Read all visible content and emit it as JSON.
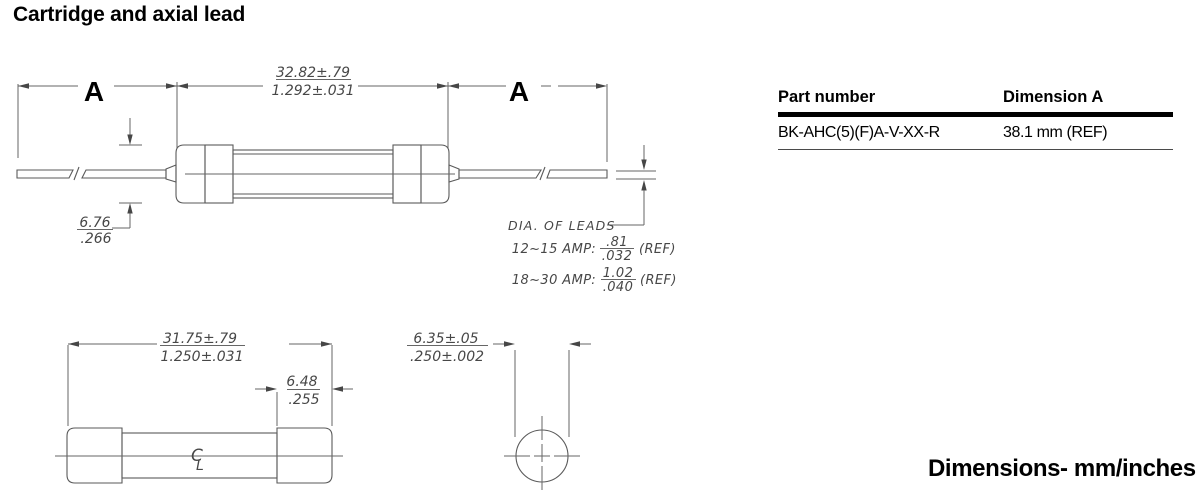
{
  "title": "Cartridge and axial lead",
  "units_note": "Dimensions- mm/inches",
  "table": {
    "col1_header": "Part number",
    "col2_header": "Dimension A",
    "row": {
      "part_number": "BK-AHC(5)(F)A-V-XX-R",
      "dimension_a": "38.1 mm (REF)"
    }
  },
  "top_view": {
    "lead_dim_label_left": "A",
    "lead_dim_label_right": "A",
    "body_length_mm": "32.82±.79",
    "body_length_in": "1.292±.031",
    "cap_dia_mm": "6.76",
    "cap_dia_in": ".266",
    "lead_note_label": "DIA. OF LEADS",
    "lead_note_rows": [
      {
        "range": "12~15 AMP:",
        "mm": ".81",
        "in": ".032",
        "ref": "(REF)"
      },
      {
        "range": "18~30 AMP:",
        "mm": "1.02",
        "in": ".040",
        "ref": "(REF)"
      }
    ]
  },
  "side_view": {
    "body_length_mm": "31.75±.79",
    "body_length_in": "1.250±.031",
    "cap_length_mm": "6.48",
    "cap_length_in": ".255",
    "centerline_c": "C",
    "centerline_l": "L"
  },
  "end_view": {
    "dia_mm": "6.35±.05",
    "dia_in": ".250±.002"
  }
}
